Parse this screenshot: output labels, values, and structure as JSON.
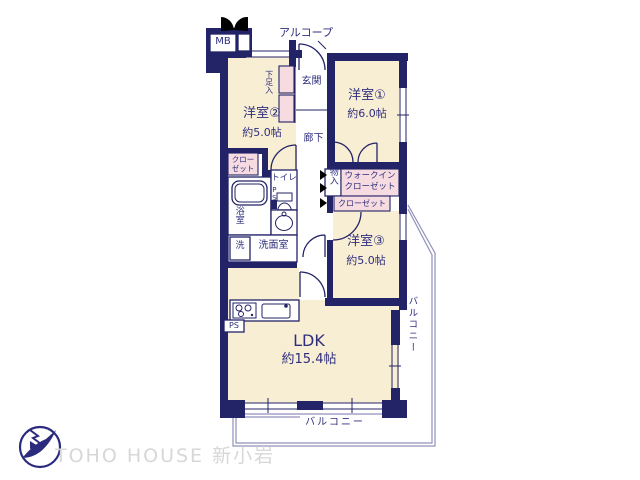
{
  "plan": {
    "rooms": {
      "bedroom1": {
        "name": "洋室①",
        "size": "約6.0帖"
      },
      "bedroom2": {
        "name": "洋室②",
        "size": "約5.0帖"
      },
      "bedroom3": {
        "name": "洋室③",
        "size": "約5.0帖"
      },
      "ldk": {
        "name": "LDK",
        "size": "約15.4帖"
      }
    },
    "labels": {
      "alcove": "アルコープ",
      "meter_box": "MB",
      "entrance": "玄関",
      "shoe_cabinet": "下足入",
      "hallway": "廊下",
      "closet_small": {
        "line1": "クロー",
        "line2": "ゼット"
      },
      "toilet": "トイレ",
      "pipe_space_toilet": "PS",
      "bathroom": "浴室",
      "laundry": "洗",
      "washroom": "洗面室",
      "storage": "物入",
      "walk_in_closet": {
        "line1": "ウォークイン",
        "line2": "クローゼット"
      },
      "closet": "クローゼット",
      "pipe_space_kitchen": "PS",
      "balcony_side": "バルコニー",
      "balcony_bottom": "バルコニー"
    },
    "colors": {
      "wall": "#232367",
      "room_fill": "#f8eed4",
      "closet_fill": "#f6dbe0",
      "text": "#2e2e7d",
      "railing": "#9090ba",
      "watermark": "#d7d7d7"
    }
  },
  "watermark": {
    "brand": "TOHO HOUSE 新小岩"
  }
}
